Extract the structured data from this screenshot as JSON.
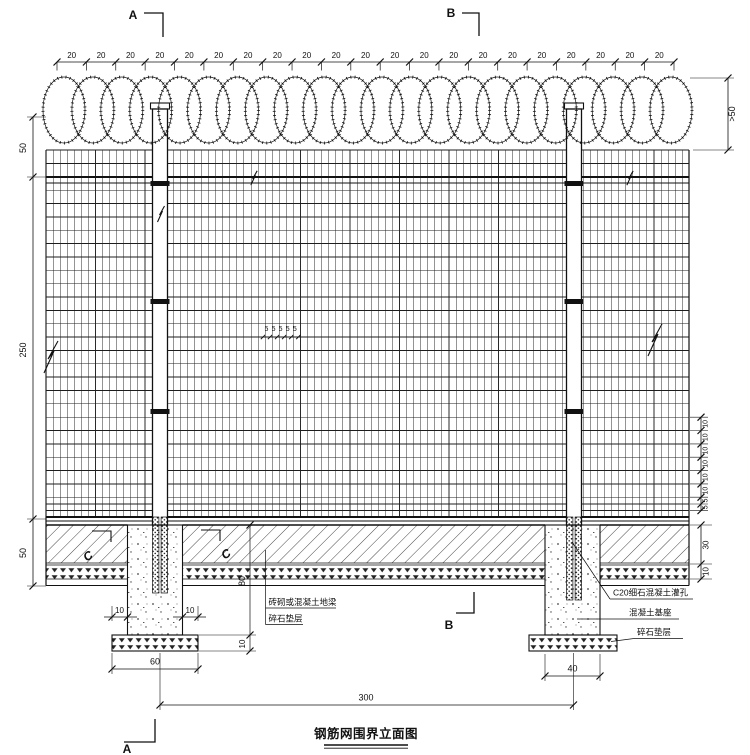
{
  "drawing": {
    "title": "钢筋网围界立面图"
  },
  "section_markers": {
    "a_top": "A",
    "b_top": "B",
    "a_bottom": "A",
    "b_bottom": "B",
    "c_left": "C",
    "c_right": "C"
  },
  "dimensions": {
    "coil_spacing": [
      "20",
      "20",
      "20",
      "20",
      "20",
      "20",
      "20",
      "20",
      "20",
      "20",
      "20",
      "20",
      "20",
      "20",
      "20",
      "20",
      "20",
      "20",
      "20",
      "20",
      "20"
    ],
    "coil_height": ">50",
    "left_top": "50",
    "left_mesh_height": "250",
    "left_ground": "50",
    "mesh_bottom_spacing": [
      "10",
      "10",
      "10",
      "10",
      "10",
      "10",
      "5",
      "5"
    ],
    "ground_beam_depth": "30",
    "cushion_depth": "10",
    "mesh_mid_spacing": [
      "5",
      "5",
      "5",
      "5",
      "5"
    ],
    "pad_overhang_left": "10",
    "pad_overhang_right": "10",
    "foundation_depth": "80",
    "pad_thickness": "10",
    "left_pad_width": "60",
    "right_pier_width": "40",
    "post_spacing": "300"
  },
  "annotations": {
    "ground_beam": "砖砌或混凝土地梁",
    "cushion_left": "碎石垫层",
    "grout": "C20细石混凝土灌孔",
    "concrete_base": "混凝土基座",
    "cushion_right": "碎石垫层"
  },
  "colors": {
    "line": "#111111",
    "background": "#ffffff"
  }
}
